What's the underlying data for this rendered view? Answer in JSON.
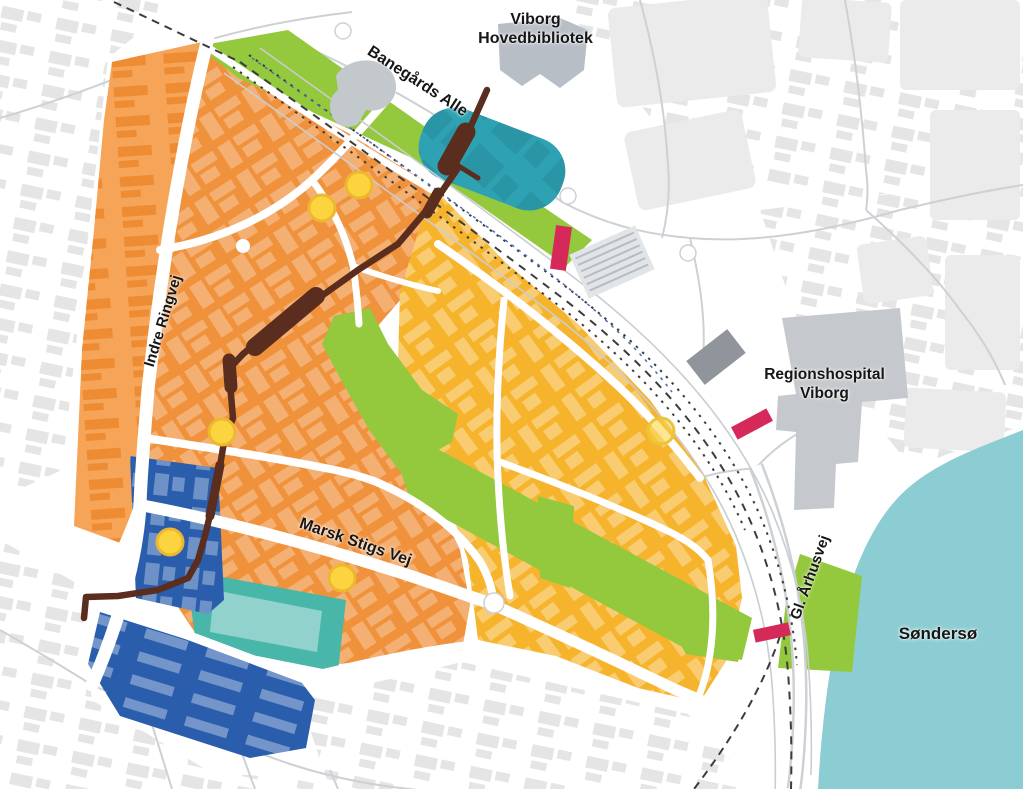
{
  "map": {
    "labels": {
      "library_line1": "Viborg",
      "library_line2": "Hovedbibliotek",
      "banegaards_alle": "Banegårds Alle",
      "indre_ringvej": "Indre Ringvej",
      "marsk_stigs_vej": "Marsk Stigs Vej",
      "regionshospital_line1": "Regionshospital",
      "regionshospital_line2": "Viborg",
      "gl_aarhusvej": "Gl. Århusvej",
      "sondersoe": "Søndersø"
    },
    "colors": {
      "district_orange": "#f0913c",
      "district_orange_light": "#f5a458",
      "district_amber": "#f6b42d",
      "district_blue": "#2a5ead",
      "district_teal": "#49b6aa",
      "pond_teal": "#2ea2b3",
      "lake_teal": "#8bcdd3",
      "green_area": "#94c83d",
      "route_brown": "#5b2d1e",
      "marker_pink": "#d5295a",
      "dot_yellow": "#fcd440",
      "dot_yellow_ring": "#edb82f",
      "landmark_gray": "#c5c9cd",
      "railway_dark": "#3c3c3c"
    },
    "features": {
      "yellow_dot_count": 6,
      "pink_marker_count": 3
    }
  }
}
